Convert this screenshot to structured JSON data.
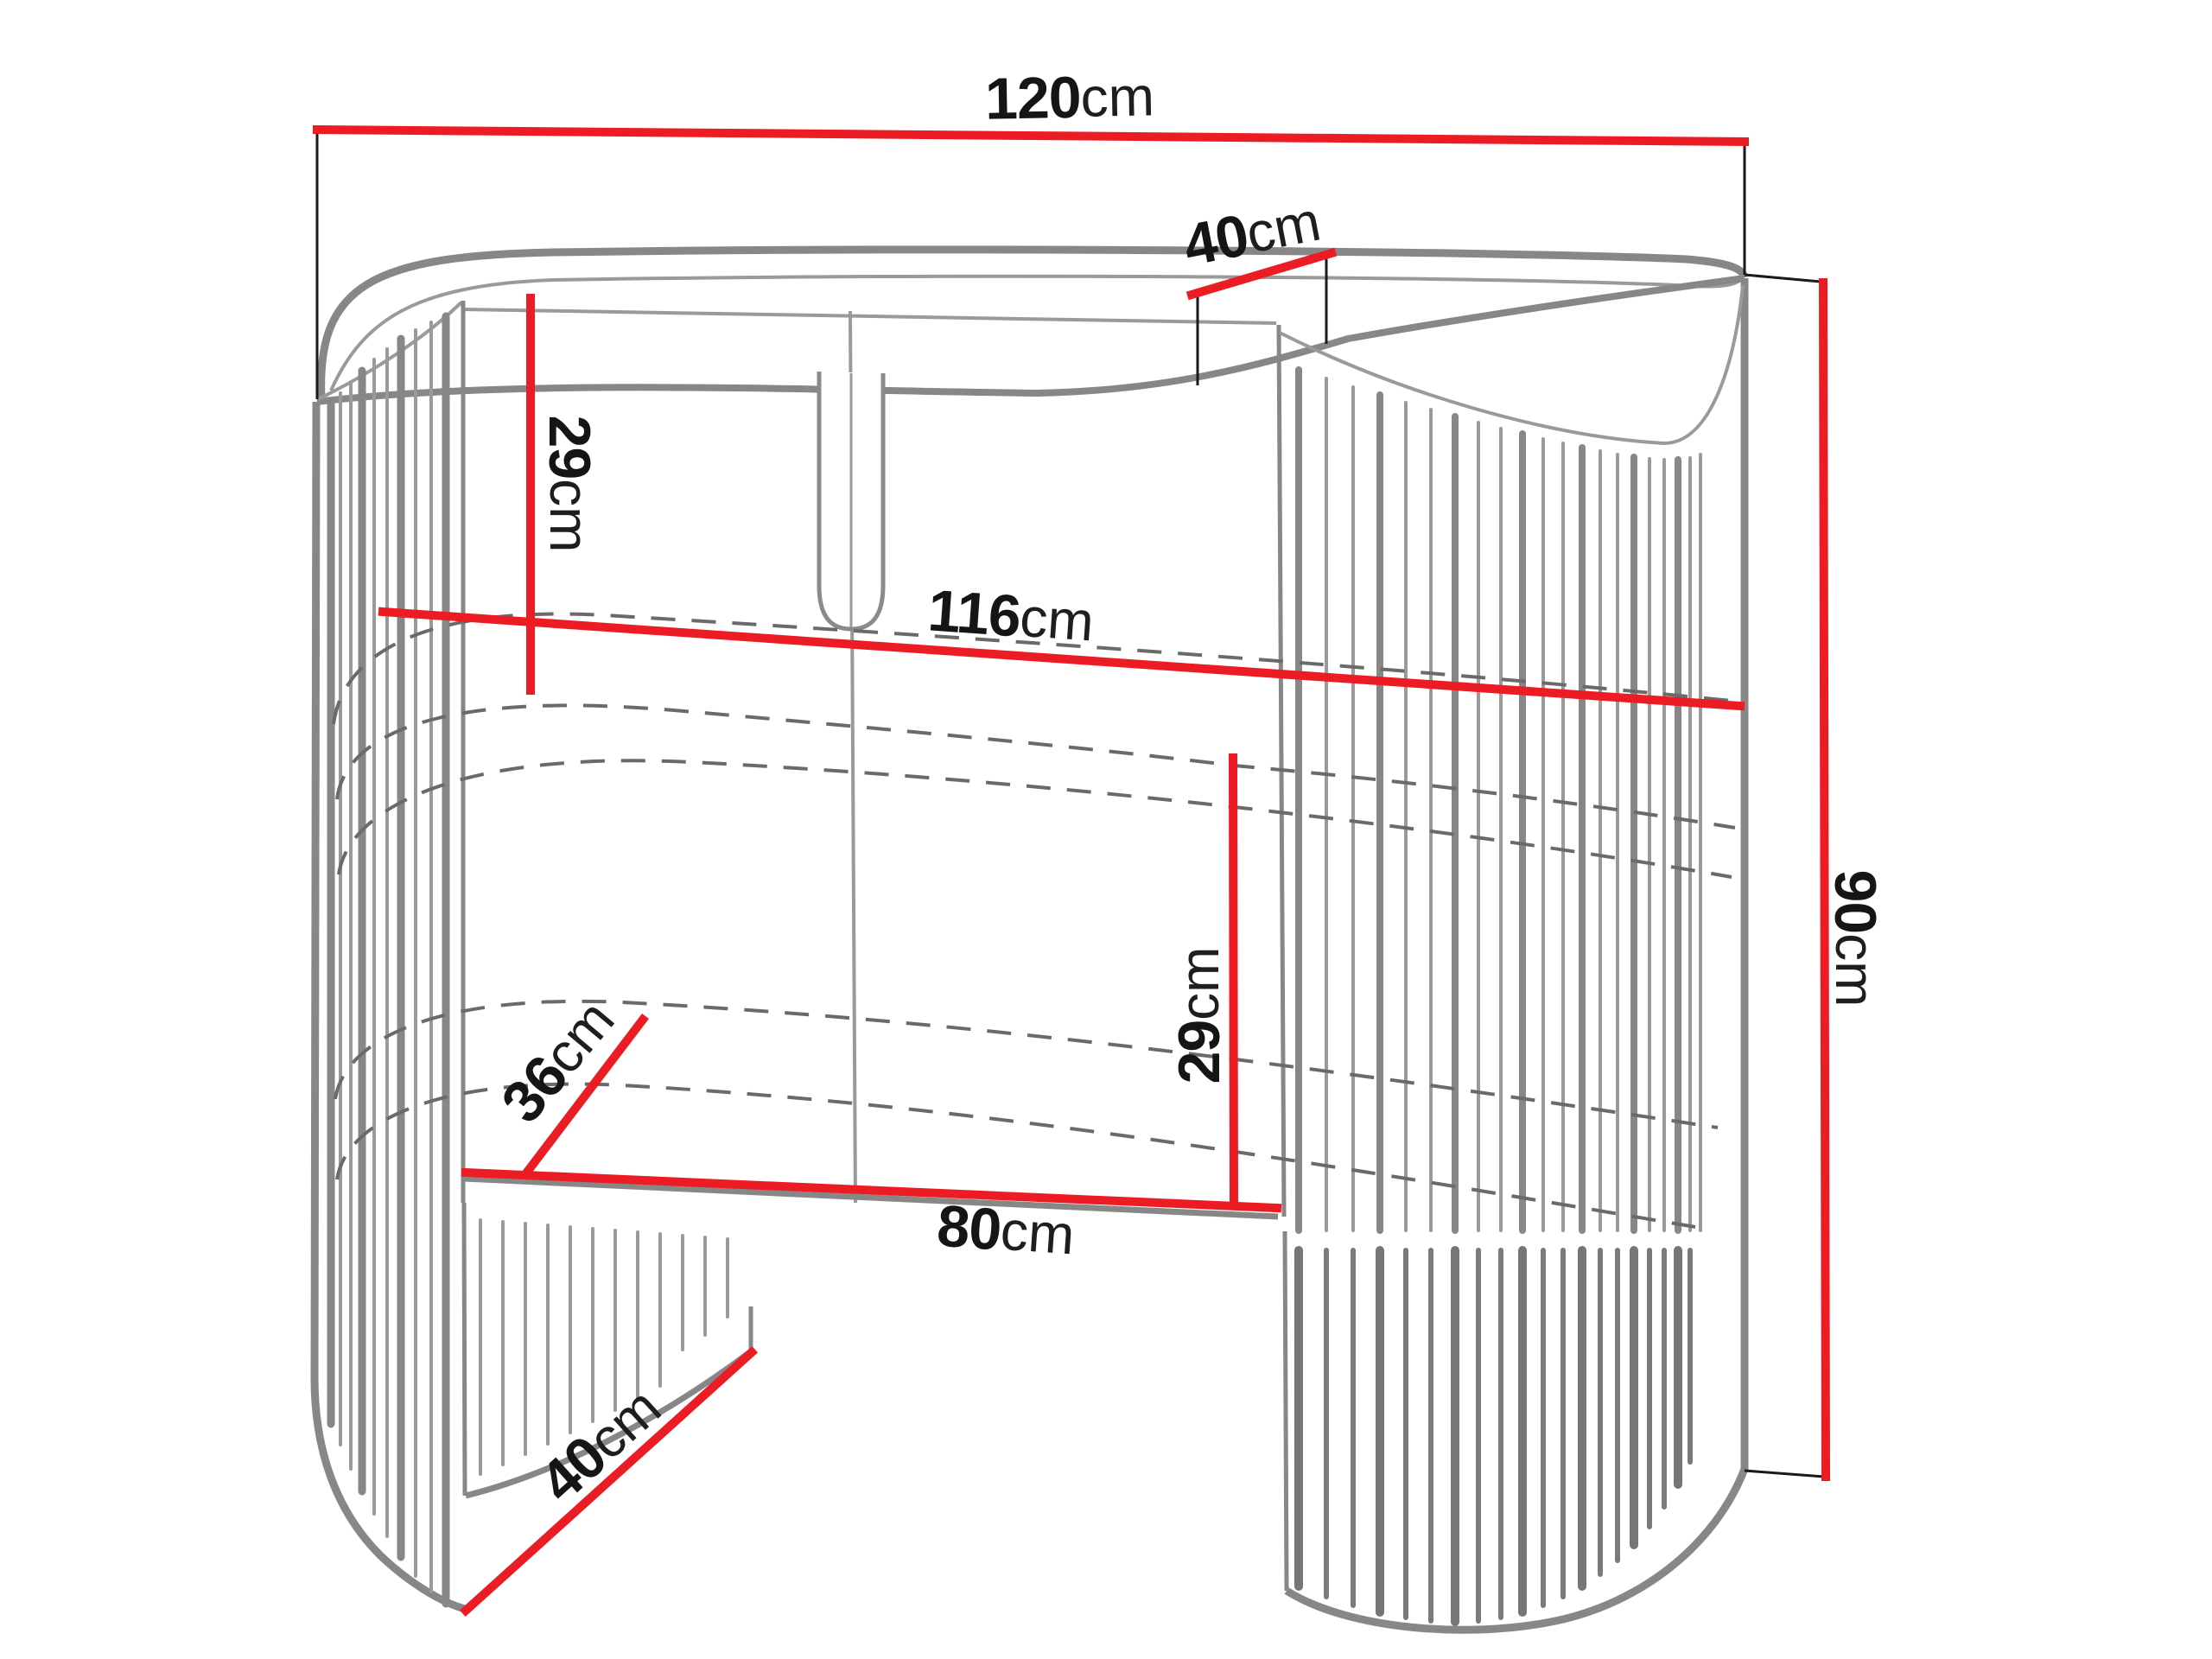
{
  "page": {
    "background": "#ffffff",
    "description": "furniture dimension diagram"
  },
  "palette": {
    "dimension_red": "#ec1c24",
    "outline_gray": "#878787",
    "dashed_gray": "#6a6a6a",
    "extension_black": "#1a1a1a",
    "label_black": "#151515"
  },
  "dims": {
    "width_top": {
      "value": "120",
      "unit": "cm"
    },
    "depth_top": {
      "value": "40",
      "unit": "cm"
    },
    "height_overall": {
      "value": "90",
      "unit": "cm"
    },
    "top_to_shelf": {
      "value": "29",
      "unit": "cm"
    },
    "inner_width": {
      "value": "116",
      "unit": "cm"
    },
    "shelf_to_desktop": {
      "value": "29",
      "unit": "cm"
    },
    "desktop_depth": {
      "value": "36",
      "unit": "cm"
    },
    "desktop_width": {
      "value": "80",
      "unit": "cm"
    },
    "base_depth": {
      "value": "40",
      "unit": "cm"
    }
  }
}
